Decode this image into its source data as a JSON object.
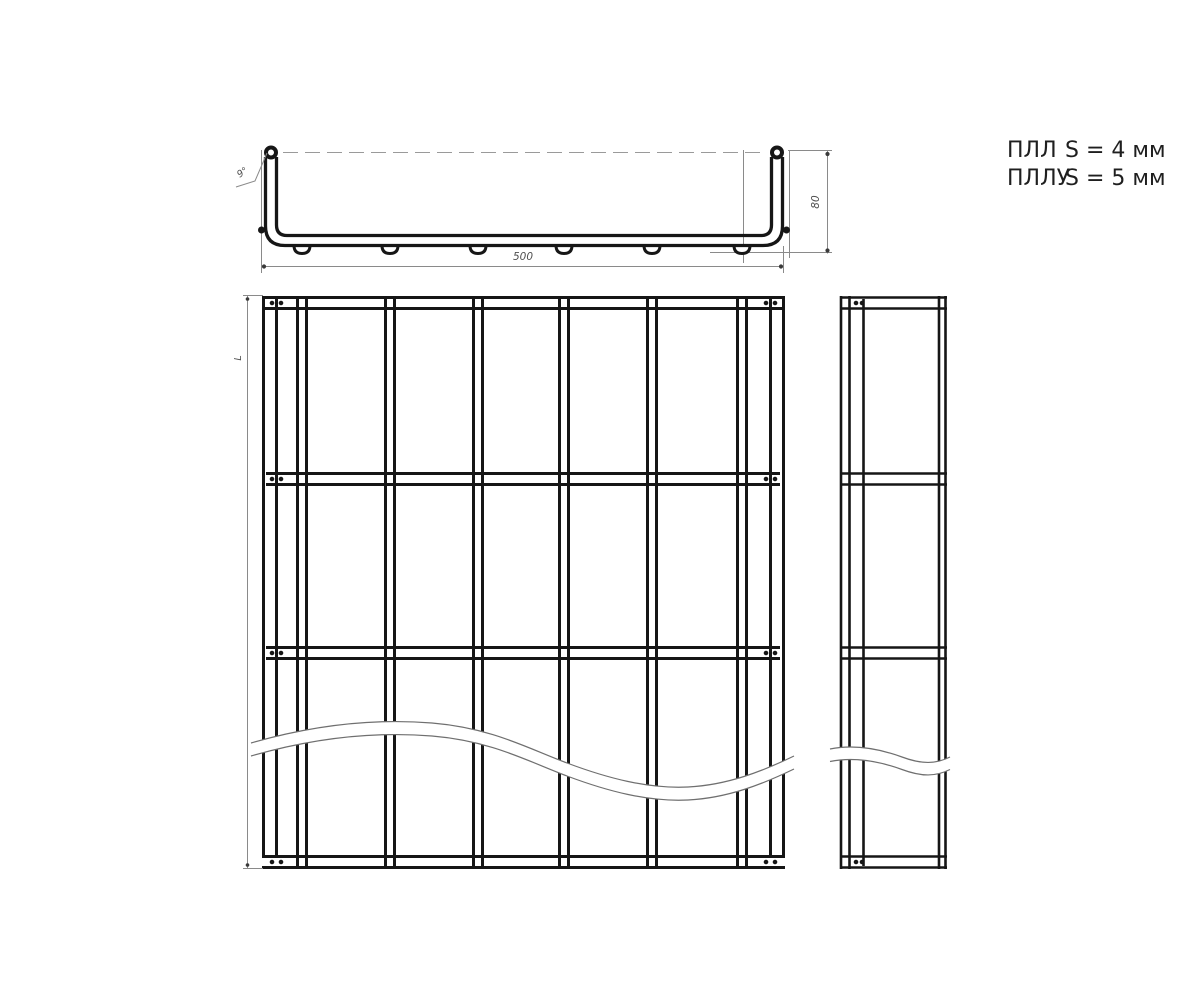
{
  "sheet": {
    "background": "#ffffff",
    "line_color": "#161616",
    "thin_line_color": "#8a8a8a",
    "dim_text_color": "#4f4f4f"
  },
  "notes": {
    "items": [
      {
        "code": "ПЛЛ",
        "thickness": "S = 4 мм"
      },
      {
        "code": "ПЛЛУ",
        "thickness": "S = 5 мм"
      }
    ]
  },
  "dimensions": {
    "width": "500",
    "height": "80",
    "length": "L",
    "corner_callout": "9°"
  }
}
